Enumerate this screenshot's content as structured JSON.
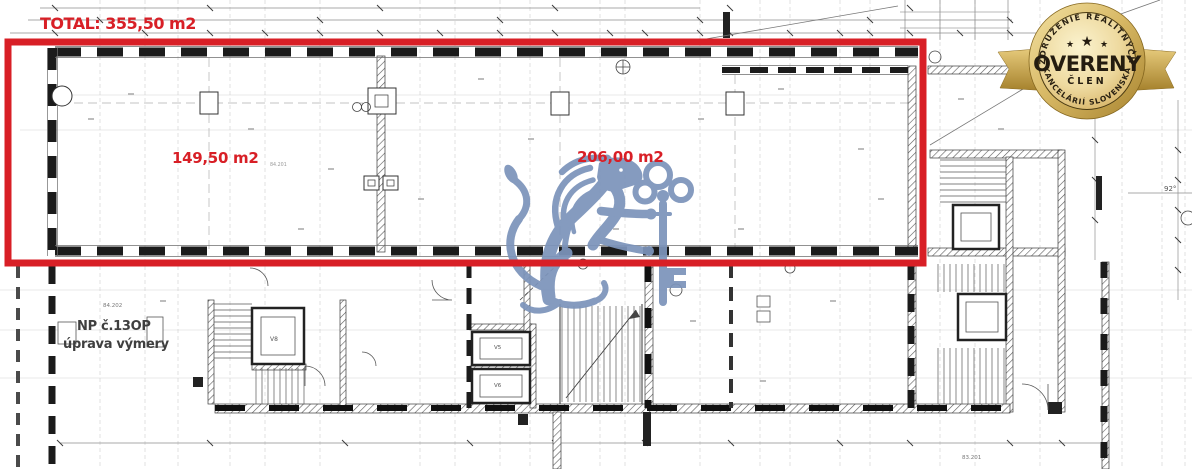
{
  "annotations": {
    "total": "TOTAL: 355,50 m2",
    "area_left": "149,50 m2",
    "area_right": "206,00 m2",
    "note_line1": "NP č.13OP",
    "note_line2": "úprava výmery",
    "red_color": "#d81f26"
  },
  "plan": {
    "angle_label": "92°",
    "ref_left": "84.202",
    "ref_area": "84.201",
    "ref_bottom_right": "83.201",
    "lift_v8": "V8",
    "lift_v5": "V5",
    "lift_v6": "V6"
  },
  "watermark": {
    "name": "lion-with-key",
    "color": "#7c94bb"
  },
  "badge": {
    "arc_top": "ZDRUŽENIE REALITNÝCH",
    "arc_bottom": "KANCELÁRIÍ SLOVENSKA",
    "stars": [
      "★",
      "★",
      "★"
    ],
    "title": "OVERENÝ",
    "subtitle": "ČLEN",
    "gold_color": "#c9a44f"
  }
}
